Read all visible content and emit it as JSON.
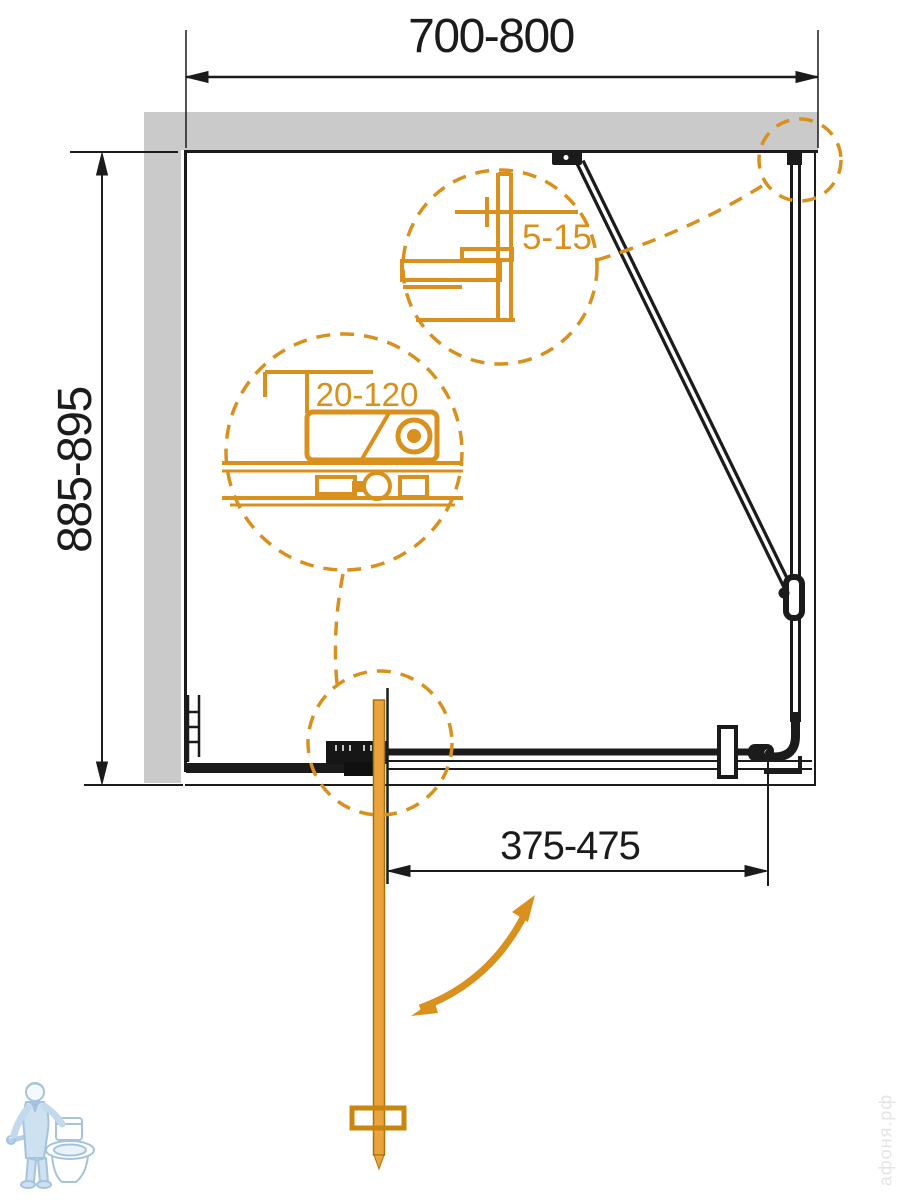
{
  "diagram": {
    "type": "shower-enclosure-plan-drawing",
    "dimensions": {
      "width_top": "700-800",
      "depth_left": "885-895",
      "door_width_bottom": "375-475",
      "detail_gap_top": "5-15",
      "detail_adjustment": "20-120"
    },
    "watermark": "афоня.рф",
    "colors": {
      "accent_orange": "#D9901D",
      "door_orange_fill": "#EBA33C",
      "door_orange_border": "#A87208",
      "wall_gray": "#CACACA",
      "line_black": "#1B1B1B",
      "logo_blue": "#A6C3DE",
      "watermark_gray": "#E4E4E4"
    },
    "icons": {
      "logo": "plumber-with-toilet-logo",
      "swing_arrow": "door-swing-arc-arrow",
      "detail_circles": "dashed-detail-callout-circles"
    }
  }
}
